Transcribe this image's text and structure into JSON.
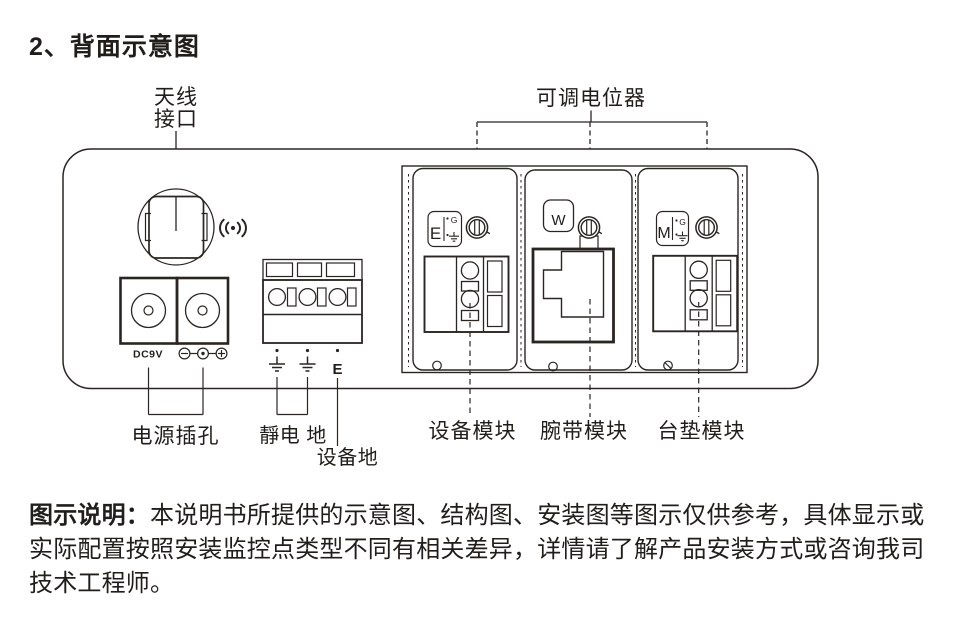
{
  "title": "2、背面示意图",
  "diagram": {
    "labels": {
      "antenna_line1": "天线",
      "antenna_line2": "接口",
      "potentiometer": "可调电位器",
      "power_jack": "电源插孔",
      "static_ground": "靜电 地",
      "device_ground": "设备地",
      "device_module": "设备模块",
      "wrist_module": "腕带模块",
      "mat_module": "台垫模块"
    },
    "markings": {
      "dc_rating": "DC9V",
      "earth_terminal": "E",
      "module_e_letter": "E",
      "module_w_letter": "W",
      "module_m_letter": "M",
      "gain_e": "G",
      "gain_m": "G"
    },
    "colors": {
      "ink": "#2a2522",
      "background": "#ffffff"
    }
  },
  "note": {
    "label": "图示说明：",
    "line1": "本说明书所提供的示意图、结构图、安装图等图示仅供参考，具体显示或",
    "line2": "实际配置按照安装监控点类型不同有相关差异，详情请了解产品安装方式或咨询我司",
    "line3": "技术工程师。"
  }
}
